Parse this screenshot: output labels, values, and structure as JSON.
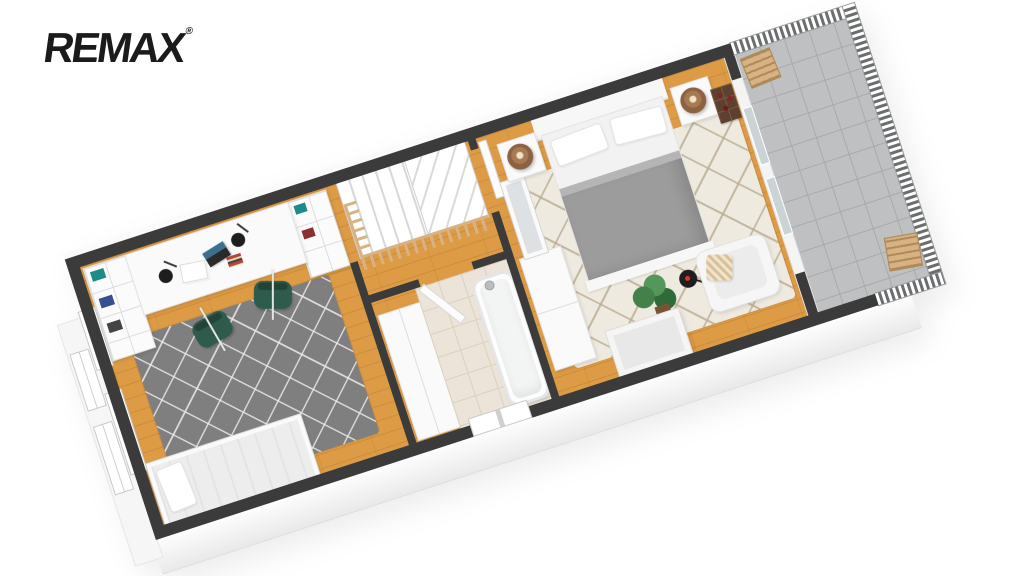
{
  "brand": {
    "logo_text": "REMAX",
    "registered_mark": "®"
  },
  "floorplan": {
    "view": "3d-dollhouse-floor-plan",
    "orientation": "rotated-diagonal",
    "rooms": [
      {
        "id": "office",
        "floor": "hardwood",
        "furniture": [
          "bookshelf-left",
          "bookshelf-right",
          "long-desk",
          "desk-lamp",
          "desk-lamp",
          "laptop",
          "papers",
          "desk-organizer",
          "office-chair",
          "office-chair",
          "gray-trellis-rug",
          "daybed",
          "pillow",
          "wall-windows"
        ]
      },
      {
        "id": "landing",
        "floor": "hardwood",
        "furniture": [
          "winder-staircase",
          "wood-stair-railing",
          "white-wardrobe",
          "bathroom-door"
        ]
      },
      {
        "id": "bathroom",
        "floor": "beige-tile",
        "furniture": [
          "bathtub",
          "chrome-fixture",
          "window"
        ]
      },
      {
        "id": "bedroom",
        "floor": "hardwood",
        "furniture": [
          "double-bed",
          "white-headboard",
          "gray-duvet",
          "pillow",
          "pillow",
          "nightstand",
          "nightstand",
          "copper-table-lamp",
          "copper-table-lamp",
          "tall-wardrobe",
          "standing-mirror",
          "cream-trellis-rug",
          "wine-crate",
          "potted-plant",
          "black-floor-lamp",
          "white-armchair",
          "striped-throw-pillow",
          "leaning-picture-frame"
        ]
      },
      {
        "id": "balcony",
        "floor": "gray-tile",
        "furniture": [
          "baluster-railing",
          "wooden-chair",
          "wooden-chair",
          "french-doors"
        ]
      }
    ]
  },
  "colors": {
    "logo": "#1b1b1b",
    "wall-top": "#3b3b3b",
    "wall-face": "#f4f4f4",
    "wood": "#dd9b45",
    "tile-bath": "#ece4d8",
    "tile-bath-line": "#d9d0c0",
    "tile-balcony": "#bec0c2",
    "tile-balcony-line": "#a7a9ab",
    "rug-gray": "#7f7f7f",
    "rug-cream": "#efeae0",
    "duvet": "#9c9c9c",
    "chair-green": "#2e5b4b",
    "railing-wood": "#d9b283",
    "copper": "#8d6243",
    "crate": "#5e4031",
    "plant": "#43804a",
    "pot": "#7a5236",
    "lamp-black": "#1e1e1e",
    "accent-red": "#e03131"
  }
}
